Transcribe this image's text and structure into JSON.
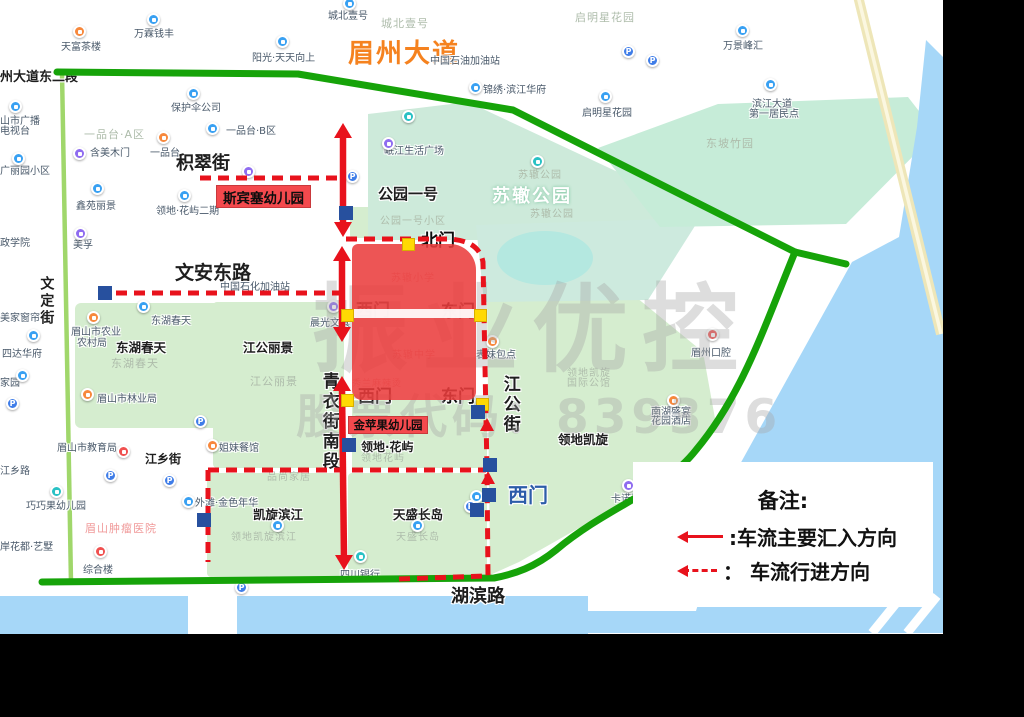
{
  "watermark": {
    "line1": "振业优控",
    "line2": "股票代码：839376"
  },
  "legend": {
    "title": "备注:",
    "items": [
      {
        "symbol": "solid-red-arrow",
        "label": ":车流主要汇入方向"
      },
      {
        "symbol": "dashed-red-arrow",
        "label": "： 车流行进方向"
      }
    ]
  },
  "colors": {
    "annotation_red": "#e8121c",
    "annotation_green": "#16a309",
    "gate_yellow": "#ffd903",
    "marker_navy": "#27509e",
    "campus_red": "#ea3e3e",
    "label_box_red": "#f4494d",
    "road_name_orange": "#f5821f",
    "water_blue": "#a6d7f8",
    "block_green": "#d5edcf",
    "park_mint": "#cdeada"
  },
  "map": {
    "campus_block": {
      "name": "苏辙小学/苏辙中学校区"
    },
    "labels": [
      {
        "t": "眉州大道",
        "x": 348,
        "y": 40,
        "c": "road-orange halo",
        "s": 26,
        "n": "road-label-meizhou-dadao"
      },
      {
        "t": "州大道东二段",
        "x": 0,
        "y": 71,
        "c": "st halo",
        "s": 13,
        "n": "road-label-meizhou-east2"
      },
      {
        "t": "积翠街",
        "x": 176,
        "y": 154,
        "c": "st halo",
        "s": 18,
        "n": "road-label-jicui-street"
      },
      {
        "t": "文安东路",
        "x": 175,
        "y": 263,
        "c": "st halo",
        "s": 19,
        "n": "road-label-wenan-east-road"
      },
      {
        "t": "文定街",
        "x": 38,
        "y": 276,
        "c": "stv halo",
        "s": 14,
        "n": "road-label-wending-street"
      },
      {
        "t": "青衣街南段",
        "x": 319,
        "y": 372,
        "c": "stv halo",
        "s": 17,
        "n": "road-label-qingyi-street-south"
      },
      {
        "t": "江公街",
        "x": 500,
        "y": 375,
        "c": "stv halo",
        "s": 17,
        "n": "road-label-jianggong-street"
      },
      {
        "t": "江乡街",
        "x": 145,
        "y": 453,
        "c": "st halo",
        "s": 12,
        "n": "road-label-jiangxiang-street"
      },
      {
        "t": "湖滨路",
        "x": 451,
        "y": 587,
        "c": "st halo",
        "s": 18,
        "n": "road-label-hubin-road"
      },
      {
        "t": "公园一号",
        "x": 378,
        "y": 186,
        "c": "st halo",
        "s": 15,
        "n": "estate-label"
      },
      {
        "t": "东湖春天",
        "x": 116,
        "y": 341,
        "c": "st halo",
        "s": 12.5,
        "n": "estate-label"
      },
      {
        "t": "江公丽景",
        "x": 243,
        "y": 341,
        "c": "st halo",
        "s": 12.5,
        "n": "estate-label"
      },
      {
        "t": "凯旋滨江",
        "x": 253,
        "y": 508,
        "c": "st halo",
        "s": 12.5,
        "n": "estate-label"
      },
      {
        "t": "天盛长岛",
        "x": 393,
        "y": 508,
        "c": "st halo",
        "s": 12.5,
        "n": "estate-label"
      },
      {
        "t": "领地凯旋",
        "x": 558,
        "y": 433,
        "c": "st halo",
        "s": 12.5,
        "n": "estate-label"
      },
      {
        "t": "领地·花屿",
        "x": 361,
        "y": 441,
        "c": "st halo",
        "s": 12,
        "n": "estate-label"
      },
      {
        "t": "北门",
        "x": 421,
        "y": 232,
        "c": "gate halo",
        "s": 17,
        "n": "gate-label-north"
      },
      {
        "t": "西门",
        "x": 356,
        "y": 302,
        "c": "gate halo",
        "s": 17,
        "n": "gate-label-west-1"
      },
      {
        "t": "东门",
        "x": 441,
        "y": 303,
        "c": "gate halo",
        "s": 17,
        "n": "gate-label-east-1"
      },
      {
        "t": "西门",
        "x": 358,
        "y": 388,
        "c": "gate halo",
        "s": 17,
        "n": "gate-label-west-2"
      },
      {
        "t": "东门",
        "x": 441,
        "y": 388,
        "c": "gate halo",
        "s": 17,
        "n": "gate-label-east-2"
      },
      {
        "t": "西门",
        "x": 508,
        "y": 484,
        "c": "gate-blue halo",
        "s": 20,
        "n": "gate-label-west-3"
      },
      {
        "t": "苏辙小学",
        "x": 379,
        "y": 251,
        "c": "school",
        "s": 19,
        "n": "school-label-suzhe-primary"
      },
      {
        "t": "苏辙中学",
        "x": 377,
        "y": 327,
        "c": "school",
        "s": 19,
        "n": "school-label-suzhe-middle"
      },
      {
        "t": "苏辙小学",
        "x": 391,
        "y": 273,
        "c": "school-faint",
        "s": 10,
        "n": "basemap-label"
      },
      {
        "t": "苏辙中学",
        "x": 392,
        "y": 350,
        "c": "school-faint",
        "s": 10,
        "n": "basemap-label"
      },
      {
        "t": "秀兰麻辣烫",
        "x": 352,
        "y": 380,
        "c": "school-faint",
        "s": 9,
        "n": "basemap-label"
      },
      {
        "t": "苏辙公园",
        "x": 492,
        "y": 187,
        "c": "park-white",
        "s": 18,
        "n": "park-label"
      },
      {
        "t": "苏辙公园",
        "x": 518,
        "y": 170,
        "c": "area",
        "s": 10,
        "n": "park-label"
      },
      {
        "t": "苏辙公园",
        "x": 530,
        "y": 209,
        "c": "area",
        "s": 10,
        "n": "park-label"
      },
      {
        "t": "东坡竹园",
        "x": 706,
        "y": 138,
        "c": "area",
        "s": 11,
        "n": "park-label"
      },
      {
        "t": "一品台·A区",
        "x": 84,
        "y": 129,
        "c": "area",
        "s": 11,
        "n": "area-label"
      },
      {
        "t": "城北壹号",
        "x": 381,
        "y": 18,
        "c": "area",
        "s": 11,
        "n": "area-label"
      },
      {
        "t": "启明星花园",
        "x": 575,
        "y": 12,
        "c": "area",
        "s": 11,
        "n": "area-label"
      },
      {
        "t": "东湖春天",
        "x": 111,
        "y": 358,
        "c": "area",
        "s": 11,
        "n": "area-label"
      },
      {
        "t": "江公丽景",
        "x": 250,
        "y": 376,
        "c": "area",
        "s": 11,
        "n": "area-label"
      },
      {
        "t": "领地凯旋",
        "x": 567,
        "y": 368,
        "c": "area",
        "s": 10,
        "n": "area-label"
      },
      {
        "t": "国际公馆",
        "x": 567,
        "y": 378,
        "c": "area",
        "s": 10,
        "n": "area-label"
      },
      {
        "t": "领地花屿",
        "x": 361,
        "y": 453,
        "c": "area",
        "s": 10,
        "n": "area-label"
      },
      {
        "t": "天盛长岛",
        "x": 396,
        "y": 532,
        "c": "area",
        "s": 10,
        "n": "area-label"
      },
      {
        "t": "领地凯旋滨江",
        "x": 231,
        "y": 532,
        "c": "area",
        "s": 10,
        "n": "area-label"
      },
      {
        "t": "品尚家居",
        "x": 267,
        "y": 472,
        "c": "area",
        "s": 10,
        "n": "area-label"
      },
      {
        "t": "公园一号小区",
        "x": 380,
        "y": 216,
        "c": "area",
        "s": 10,
        "n": "area-label"
      },
      {
        "t": "天富茶楼",
        "x": 61,
        "y": 42,
        "c": "poi halo",
        "s": 10,
        "n": "poi-label"
      },
      {
        "t": "万霖钱丰",
        "x": 134,
        "y": 29,
        "c": "poi halo",
        "s": 10,
        "n": "poi-label"
      },
      {
        "t": "阳光·天天向上",
        "x": 252,
        "y": 53,
        "c": "poi halo",
        "s": 10,
        "n": "poi-label"
      },
      {
        "t": "城北壹号",
        "x": 328,
        "y": 11,
        "c": "poi halo",
        "s": 10,
        "n": "poi-label"
      },
      {
        "t": "保护伞公司",
        "x": 171,
        "y": 103,
        "c": "poi halo",
        "s": 10,
        "n": "poi-label"
      },
      {
        "t": "一品台·B区",
        "x": 226,
        "y": 126,
        "c": "poi halo",
        "s": 10,
        "n": "poi-label"
      },
      {
        "t": "一品台",
        "x": 150,
        "y": 148,
        "c": "poi halo",
        "s": 10,
        "n": "poi-label"
      },
      {
        "t": "含美木门",
        "x": 90,
        "y": 148,
        "c": "poi halo",
        "s": 10,
        "n": "poi-label"
      },
      {
        "t": "鑫苑丽景",
        "x": 76,
        "y": 201,
        "c": "poi halo",
        "s": 10,
        "n": "poi-label"
      },
      {
        "t": "领地·花屿二期",
        "x": 156,
        "y": 206,
        "c": "poi halo",
        "s": 10,
        "n": "poi-label"
      },
      {
        "t": "美孚",
        "x": 73,
        "y": 240,
        "c": "poi halo",
        "s": 10,
        "n": "poi-label"
      },
      {
        "t": "岷江生活广场",
        "x": 384,
        "y": 146,
        "c": "poi halo",
        "s": 10,
        "n": "poi-label"
      },
      {
        "t": "万景峰汇",
        "x": 723,
        "y": 41,
        "c": "poi halo",
        "s": 10,
        "n": "poi-label"
      },
      {
        "t": "锦绣·滨江华府",
        "x": 483,
        "y": 85,
        "c": "poi halo",
        "s": 10,
        "n": "poi-label"
      },
      {
        "t": "启明星花园",
        "x": 582,
        "y": 108,
        "c": "poi halo",
        "s": 10,
        "n": "poi-label"
      },
      {
        "t": "滨江大道",
        "x": 752,
        "y": 99,
        "c": "poi halo",
        "s": 10,
        "n": "poi-label"
      },
      {
        "t": "第一居民点",
        "x": 749,
        "y": 109,
        "c": "poi halo",
        "s": 10,
        "n": "poi-label"
      },
      {
        "t": "中国石油加油站",
        "x": 430,
        "y": 56,
        "c": "poi halo",
        "s": 10,
        "n": "poi-label"
      },
      {
        "t": "中国石化加油站",
        "x": 220,
        "y": 282,
        "c": "poi halo",
        "s": 10,
        "n": "poi-label"
      },
      {
        "t": "东湖春天",
        "x": 151,
        "y": 316,
        "c": "poi halo",
        "s": 10,
        "n": "poi-label"
      },
      {
        "t": "眉山市农业",
        "x": 71,
        "y": 327,
        "c": "poi halo",
        "s": 10,
        "n": "poi-label"
      },
      {
        "t": "农村局",
        "x": 77,
        "y": 338,
        "c": "poi halo",
        "s": 10,
        "n": "poi-label"
      },
      {
        "t": "眉山市林业局",
        "x": 97,
        "y": 394,
        "c": "poi halo",
        "s": 10,
        "n": "poi-label"
      },
      {
        "t": "眉山市教育局",
        "x": 57,
        "y": 443,
        "c": "poi halo",
        "s": 10,
        "n": "poi-label"
      },
      {
        "t": "姐妹餐馆",
        "x": 219,
        "y": 443,
        "c": "poi halo",
        "s": 10,
        "n": "poi-label"
      },
      {
        "t": "巧巧果幼儿园",
        "x": 26,
        "y": 501,
        "c": "poi halo",
        "s": 10,
        "n": "poi-label"
      },
      {
        "t": "外滩·金色年华",
        "x": 195,
        "y": 498,
        "c": "poi halo",
        "s": 10,
        "n": "poi-label"
      },
      {
        "t": "四川银行",
        "x": 340,
        "y": 570,
        "c": "poi halo",
        "s": 10,
        "n": "poi-label"
      },
      {
        "t": "综合楼",
        "x": 83,
        "y": 565,
        "c": "poi halo",
        "s": 10,
        "n": "poi-label"
      },
      {
        "t": "山市广播",
        "x": 0,
        "y": 116,
        "c": "poi halo",
        "s": 10,
        "n": "poi-label"
      },
      {
        "t": "电视台",
        "x": 0,
        "y": 126,
        "c": "poi halo",
        "s": 10,
        "n": "poi-label"
      },
      {
        "t": "广丽园小区",
        "x": 0,
        "y": 166,
        "c": "poi halo",
        "s": 10,
        "n": "poi-label"
      },
      {
        "t": "政学院",
        "x": 0,
        "y": 238,
        "c": "poi halo",
        "s": 10,
        "n": "poi-label"
      },
      {
        "t": "美家窗帘",
        "x": 0,
        "y": 313,
        "c": "poi halo",
        "s": 10,
        "n": "poi-label"
      },
      {
        "t": "四达华府",
        "x": 2,
        "y": 349,
        "c": "poi halo",
        "s": 10,
        "n": "poi-label"
      },
      {
        "t": "家园",
        "x": 0,
        "y": 378,
        "c": "poi halo",
        "s": 10,
        "n": "poi-label"
      },
      {
        "t": "江乡路",
        "x": 0,
        "y": 466,
        "c": "poi halo",
        "s": 10,
        "n": "poi-label"
      },
      {
        "t": "岸花都·艺墅",
        "x": 0,
        "y": 542,
        "c": "poi halo",
        "s": 10,
        "n": "poi-label"
      },
      {
        "t": "晨光文具",
        "x": 310,
        "y": 318,
        "c": "poi halo",
        "s": 10,
        "n": "poi-label"
      },
      {
        "t": "表妹包点",
        "x": 476,
        "y": 350,
        "c": "poi halo",
        "s": 10,
        "n": "poi-label"
      },
      {
        "t": "眉州口腔",
        "x": 691,
        "y": 348,
        "c": "poi halo",
        "s": 10,
        "n": "poi-label"
      },
      {
        "t": "南湖盛宴",
        "x": 651,
        "y": 407,
        "c": "poi halo",
        "s": 10,
        "n": "poi-label"
      },
      {
        "t": "花园酒店",
        "x": 651,
        "y": 416,
        "c": "poi halo",
        "s": 10,
        "n": "poi-label"
      },
      {
        "t": "卡诺亚定制",
        "x": 611,
        "y": 494,
        "c": "poi halo",
        "s": 10,
        "n": "poi-label"
      },
      {
        "t": "眉山肿瘤医院",
        "x": 85,
        "y": 523,
        "c": "pink",
        "s": 11,
        "n": "hospital-area-label"
      }
    ],
    "red_boxes": [
      {
        "t": "斯宾塞幼儿园",
        "x": 216,
        "y": 185,
        "w": 93,
        "h": 21,
        "s": 13.5,
        "n": "kindergarten-label-sibinsai"
      },
      {
        "t": "金苹果幼儿园",
        "x": 348,
        "y": 416,
        "w": 78,
        "h": 16,
        "s": 11.5,
        "n": "kindergarten-label-jinpingguo"
      }
    ],
    "pins": [
      [
        153,
        19,
        "blue"
      ],
      [
        282,
        41,
        "blue"
      ],
      [
        349,
        3,
        "blue"
      ],
      [
        193,
        93,
        "blue"
      ],
      [
        212,
        128,
        "blue"
      ],
      [
        97,
        188,
        "blue"
      ],
      [
        184,
        195,
        "blue"
      ],
      [
        15,
        106,
        "blue"
      ],
      [
        18,
        158,
        "blue"
      ],
      [
        143,
        306,
        "blue"
      ],
      [
        33,
        335,
        "blue"
      ],
      [
        22,
        375,
        "blue"
      ],
      [
        277,
        525,
        "blue"
      ],
      [
        417,
        525,
        "blue"
      ],
      [
        188,
        501,
        "blue"
      ],
      [
        476,
        496,
        "blue"
      ],
      [
        605,
        96,
        "blue"
      ],
      [
        742,
        30,
        "blue"
      ],
      [
        770,
        84,
        "blue"
      ],
      [
        475,
        87,
        "blue"
      ],
      [
        352,
        176,
        "p"
      ],
      [
        628,
        51,
        "p"
      ],
      [
        652,
        60,
        "p"
      ],
      [
        200,
        421,
        "p"
      ],
      [
        12,
        403,
        "p"
      ],
      [
        110,
        475,
        "p"
      ],
      [
        169,
        480,
        "p"
      ],
      [
        470,
        506,
        "p"
      ],
      [
        241,
        587,
        "p"
      ],
      [
        79,
        31,
        "orange"
      ],
      [
        163,
        137,
        "orange"
      ],
      [
        93,
        317,
        "orange"
      ],
      [
        87,
        394,
        "orange"
      ],
      [
        212,
        445,
        "orange"
      ],
      [
        492,
        341,
        "orange"
      ],
      [
        673,
        400,
        "orange"
      ],
      [
        100,
        551,
        "red"
      ],
      [
        123,
        451,
        "red"
      ],
      [
        712,
        334,
        "red"
      ],
      [
        80,
        233,
        "purple"
      ],
      [
        79,
        153,
        "purple"
      ],
      [
        248,
        171,
        "purple"
      ],
      [
        333,
        306,
        "purple"
      ],
      [
        388,
        143,
        "purple"
      ],
      [
        628,
        485,
        "purple"
      ],
      [
        56,
        491,
        "teal"
      ],
      [
        360,
        556,
        "teal"
      ],
      [
        537,
        161,
        "teal"
      ],
      [
        408,
        116,
        "teal"
      ]
    ],
    "gate_squares": [
      [
        408,
        244
      ],
      [
        347,
        315
      ],
      [
        480,
        315
      ],
      [
        347,
        400
      ],
      [
        482,
        404
      ]
    ],
    "marker_squares": [
      [
        346,
        213
      ],
      [
        105,
        293
      ],
      [
        478,
        412
      ],
      [
        490,
        465
      ],
      [
        489,
        495
      ],
      [
        477,
        510
      ],
      [
        204,
        520
      ],
      [
        349,
        445
      ]
    ]
  }
}
